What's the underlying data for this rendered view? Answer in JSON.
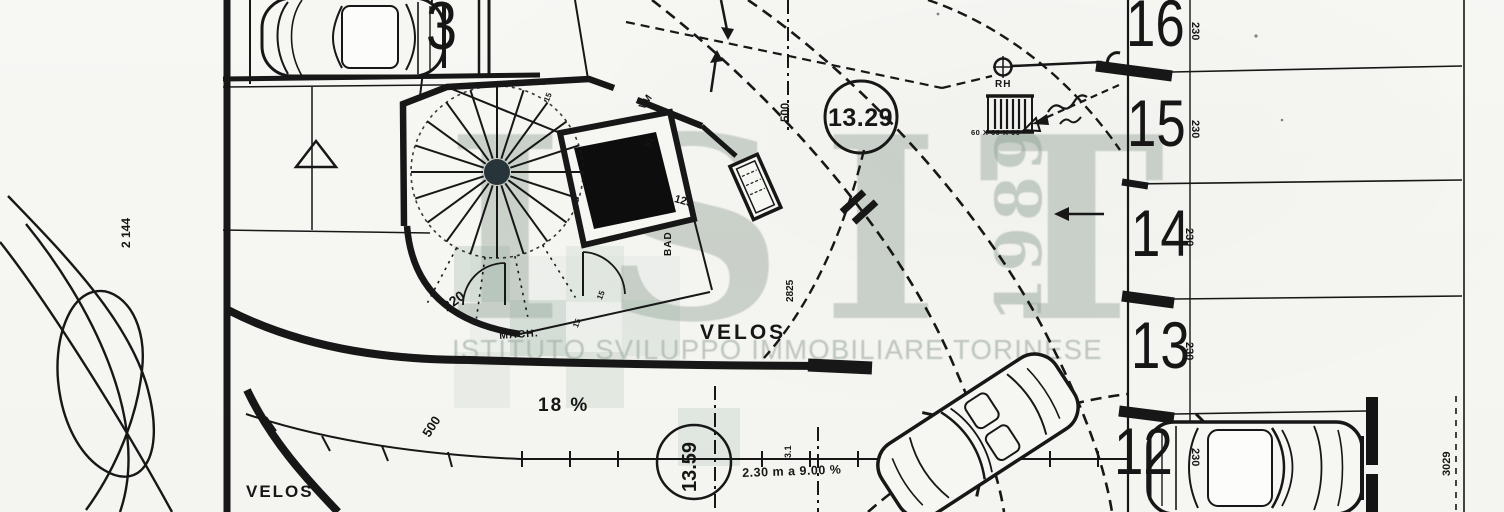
{
  "drawing_type": "scanned parking / site plan",
  "watermark": {
    "logo": "ISIT",
    "year": "1989",
    "subtitle": "ISTITUTO SVILUPPO IMMOBILIARE TORINESE",
    "color": "#8fa094"
  },
  "parking": {
    "left_stall": "3",
    "right_stalls": [
      "16",
      "15",
      "14",
      "13",
      "12"
    ],
    "stall_depth": "230"
  },
  "levels": {
    "upper": "13.29",
    "lower": "13.59"
  },
  "ramp": {
    "slope": "18 %",
    "note": "2.30 m a 9.00 %",
    "station": "3.1"
  },
  "labels": [
    {
      "name": "stall-3-number",
      "text": "3",
      "x": 426,
      "y": -8,
      "size": 68,
      "w": 400,
      "cls": "stall",
      "sx": 0.82
    },
    {
      "name": "stall-16-number",
      "text": "16",
      "x": 1126,
      "y": -10,
      "size": 66,
      "w": 400,
      "cls": "stall",
      "sx": 0.8
    },
    {
      "name": "stall-15-number",
      "text": "15",
      "x": 1127,
      "y": 90,
      "size": 66,
      "w": 400,
      "cls": "stall",
      "sx": 0.8
    },
    {
      "name": "stall-14-number",
      "text": "14",
      "x": 1131,
      "y": 200,
      "size": 66,
      "w": 400,
      "cls": "stall",
      "sx": 0.8
    },
    {
      "name": "stall-13-number",
      "text": "13",
      "x": 1131,
      "y": 312,
      "size": 66,
      "w": 400,
      "cls": "stall",
      "sx": 0.8
    },
    {
      "name": "stall-12-number",
      "text": "12",
      "x": 1114,
      "y": 418,
      "size": 66,
      "w": 400,
      "cls": "stall",
      "sx": 0.8
    },
    {
      "name": "stall-16-depth",
      "text": "230",
      "x": 1200,
      "y": 22,
      "size": 11,
      "w": 700,
      "rot": 90
    },
    {
      "name": "stall-15-depth",
      "text": "230",
      "x": 1200,
      "y": 120,
      "size": 11,
      "w": 700,
      "rot": 90
    },
    {
      "name": "stall-14-depth",
      "text": "230",
      "x": 1194,
      "y": 228,
      "size": 11,
      "w": 700,
      "rot": 90
    },
    {
      "name": "stall-13-depth",
      "text": "230",
      "x": 1194,
      "y": 342,
      "size": 11,
      "w": 700,
      "rot": 90
    },
    {
      "name": "stall-12-depth",
      "text": "230",
      "x": 1200,
      "y": 448,
      "size": 11,
      "w": 700,
      "rot": 90
    },
    {
      "name": "level-marker-upper",
      "text": "13.29",
      "x": 828,
      "y": 106,
      "size": 25,
      "w": 800,
      "ls": 0.5
    },
    {
      "name": "level-marker-lower",
      "text": "13.59",
      "x": 680,
      "y": 492,
      "size": 20,
      "w": 700,
      "rot": -90
    },
    {
      "name": "ramp-slope",
      "text": "18 %",
      "x": 538,
      "y": 396,
      "size": 19,
      "w": 700,
      "ls": 2
    },
    {
      "name": "ramp-note",
      "text": "2.30 m a 9.00 %",
      "x": 742,
      "y": 467,
      "size": 12.5,
      "w": 700,
      "rot": -2,
      "ls": 0.5
    },
    {
      "name": "ramp-station",
      "text": "3.1",
      "x": 784,
      "y": 458,
      "size": 9,
      "w": 700,
      "rot": -90
    },
    {
      "name": "dim-left-vertical",
      "text": "2 144",
      "x": 120,
      "y": 248,
      "size": 12,
      "w": 700,
      "rot": -90
    },
    {
      "name": "dim-right-vertical",
      "text": "3029",
      "x": 1442,
      "y": 476,
      "size": 11,
      "w": 700,
      "rot": -90
    },
    {
      "name": "dim-top-vertical",
      "text": "500",
      "x": 781,
      "y": 122,
      "size": 11.5,
      "w": 700,
      "rot": -90
    },
    {
      "name": "dim-section",
      "text": "2825",
      "x": 786,
      "y": 302,
      "size": 10,
      "w": 700,
      "rot": -90
    },
    {
      "name": "dim-curve-radius",
      "text": "500",
      "x": 420,
      "y": 432,
      "size": 13,
      "w": 600,
      "rot": -57
    },
    {
      "name": "dim-curve-width",
      "text": "220",
      "x": 440,
      "y": 302,
      "size": 14,
      "w": 600,
      "rot": -36
    },
    {
      "name": "dim-wall-125",
      "text": "125",
      "x": 676,
      "y": 194,
      "size": 11,
      "w": 700,
      "rot": 16
    },
    {
      "name": "dim-entry-51",
      "text": "51",
      "x": 643,
      "y": 145,
      "size": 9,
      "w": 700,
      "rot": -62
    },
    {
      "name": "dim-wall-15-a",
      "text": "15",
      "x": 543,
      "y": 100,
      "size": 8,
      "w": 700,
      "rot": -68
    },
    {
      "name": "dim-wall-15-b",
      "text": "15",
      "x": 596,
      "y": 298,
      "size": 8,
      "w": 700,
      "rot": -68
    },
    {
      "name": "dim-wall-15-c",
      "text": "15",
      "x": 572,
      "y": 326,
      "size": 8,
      "w": 700,
      "rot": -68
    },
    {
      "name": "room-velos-main",
      "text": "VELOS",
      "x": 700,
      "y": 322,
      "size": 21,
      "w": 800,
      "ls": 3
    },
    {
      "name": "room-velos-left",
      "text": "VELOS",
      "x": 246,
      "y": 483,
      "size": 17,
      "w": 800,
      "ls": 2
    },
    {
      "name": "room-mach",
      "text": "MACH.",
      "x": 499,
      "y": 331,
      "size": 10.5,
      "w": 800,
      "rot": -4,
      "ls": 1
    },
    {
      "name": "room-bad",
      "text": "BAD",
      "x": 664,
      "y": 256,
      "size": 10,
      "w": 700,
      "rot": -90,
      "ls": 1
    },
    {
      "name": "door-vm",
      "text": "VM",
      "x": 638,
      "y": 106,
      "size": 10,
      "w": 800,
      "rot": -55
    },
    {
      "name": "survey-rh-label",
      "text": "RH",
      "x": 995,
      "y": 80,
      "size": 10,
      "w": 800,
      "ls": 1
    },
    {
      "name": "survey-rh-note",
      "text": "60 X 60 X 60",
      "x": 971,
      "y": 129,
      "size": 7.5,
      "w": 800,
      "ls": 0.5
    },
    {
      "name": "watermark-logo",
      "text": "ISIT",
      "x": 446,
      "y": 104,
      "size": 252,
      "w": 700,
      "ls": 38,
      "cls": "wm",
      "col": "rgba(143,160,148,0.42)",
      "layer": "wm"
    },
    {
      "name": "watermark-year",
      "text": "1989",
      "x": 988,
      "y": 322,
      "size": 64,
      "w": 700,
      "ls": 6,
      "rot": -90,
      "cls": "wm",
      "col": "rgba(143,160,148,0.48)",
      "layer": "wm"
    },
    {
      "name": "watermark-subtitle",
      "text": "ISTITUTO SVILUPPO IMMOBILIARE TORINESE",
      "x": 452,
      "y": 336,
      "size": 27.5,
      "w": 500,
      "ls": 1.2,
      "cls": "wmsub",
      "col": "rgba(138,155,144,0.52)",
      "layer": "wm"
    }
  ]
}
